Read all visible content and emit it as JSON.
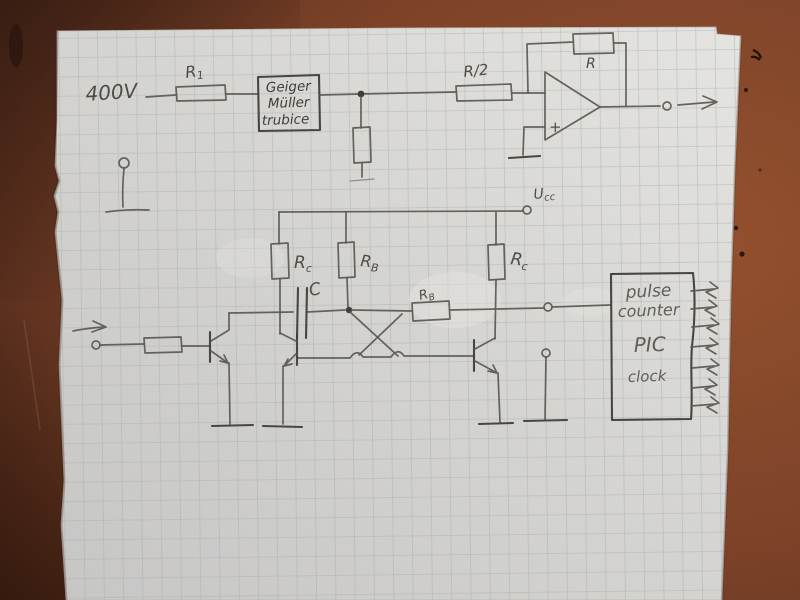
{
  "top_circuit": {
    "supply_label": "400V",
    "r1": {
      "base": "R",
      "sub": "1"
    },
    "tube_box": {
      "line1": "Geiger",
      "line2": "Müller",
      "line3": "trubice"
    },
    "divider_r": "R/2",
    "feedback_r": "R",
    "opamp_plus": "+"
  },
  "flipflop": {
    "ucc": {
      "base": "U",
      "sub": "cc"
    },
    "rc_left": {
      "base": "R",
      "sub": "c"
    },
    "rb_mid": {
      "base": "R",
      "sub": "B"
    },
    "rc_right": {
      "base": "R",
      "sub": "c"
    },
    "rb_cross": {
      "base": "R",
      "sub": "B"
    },
    "cap_label": "C"
  },
  "pic_box": {
    "line1": "pulse",
    "line2": "counter",
    "line3": "PIC",
    "line4": "clock"
  },
  "colors": {
    "table": "#82452a",
    "table_dark": "#4d2819",
    "paper": "#d6d5d1",
    "grid": "#9fa9b6",
    "pencil": "#5a5850",
    "pencil_dark": "#403e38"
  }
}
